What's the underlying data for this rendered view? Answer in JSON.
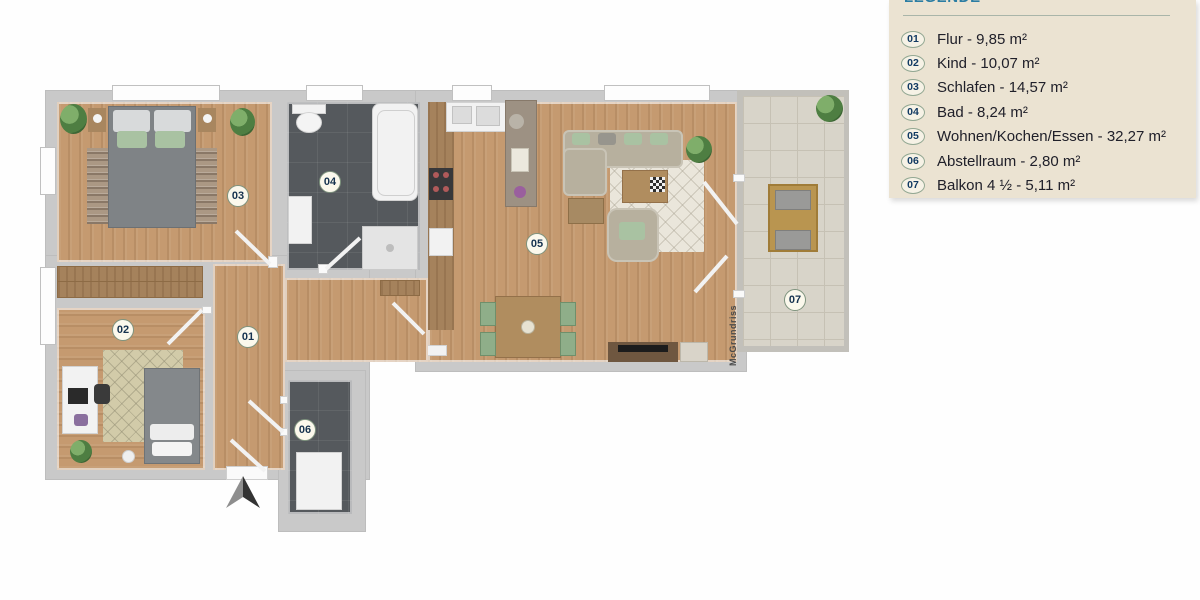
{
  "legend": {
    "title": "LEGENDE",
    "items": [
      {
        "num": "01",
        "label": "Flur - 9,85 m²"
      },
      {
        "num": "02",
        "label": "Kind - 10,07 m²"
      },
      {
        "num": "03",
        "label": "Schlafen - 14,57 m²"
      },
      {
        "num": "04",
        "label": "Bad - 8,24 m²"
      },
      {
        "num": "05",
        "label": "Wohnen/Kochen/Essen - 32,27 m²"
      },
      {
        "num": "06",
        "label": "Abstellraum - 2,80 m²"
      },
      {
        "num": "07",
        "label": "Balkon 4 ½ - 5,11 m²"
      }
    ]
  },
  "floorplan": {
    "watermark": "McGrundriss",
    "rooms": [
      {
        "num": "01",
        "name": "Flur",
        "area_m2": "9,85"
      },
      {
        "num": "02",
        "name": "Kind",
        "area_m2": "10,07"
      },
      {
        "num": "03",
        "name": "Schlafen",
        "area_m2": "14,57"
      },
      {
        "num": "04",
        "name": "Bad",
        "area_m2": "8,24"
      },
      {
        "num": "05",
        "name": "Wohnen/Kochen/Essen",
        "area_m2": "32,27"
      },
      {
        "num": "06",
        "name": "Abstellraum",
        "area_m2": "2,80"
      },
      {
        "num": "07",
        "name": "Balkon 4 ½",
        "area_m2": "5,11"
      }
    ],
    "colors": {
      "wall": "#c9c9c9",
      "wood_floor": "#c59a70",
      "bath_tile": "#55595d",
      "balcony_tile": "#d8d4c9",
      "legend_bg": "#ebe3d2",
      "legend_title": "#2b7da3",
      "badge_text": "#16324f"
    }
  }
}
